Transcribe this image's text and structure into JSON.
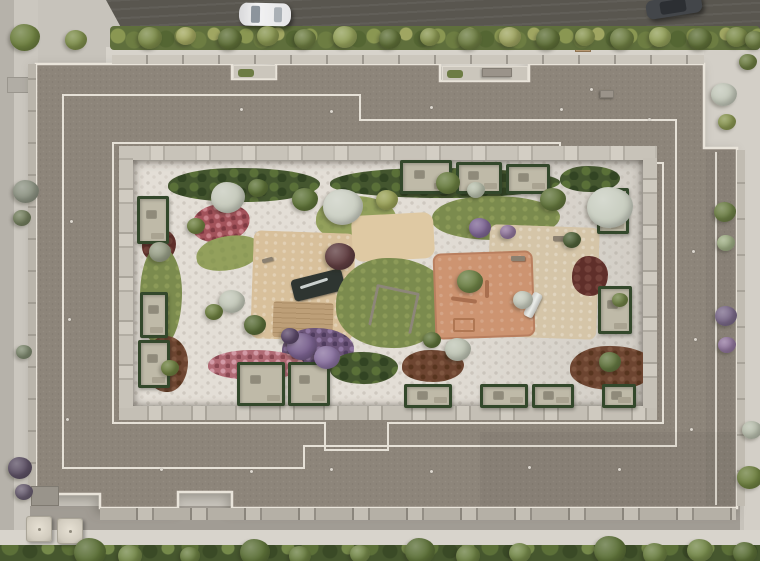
{
  "scene": {
    "type": "aerial-architectural-render",
    "description": "Top-down aerial 3D rendering of a residential perimeter-block building with stepped grey flat roofs, a landscaped inner courtyard with pebble paths, lawns, flower beds, playgrounds and private ground-floor terraces, surrounded by streets, sidewalks and greenery",
    "palette": {
      "road": "#59564f",
      "sidewalk": "#d7d3cb",
      "ground": "#c7c3bb",
      "roof": "#8d857a",
      "parapet": "#e9e4da",
      "courtyard_pebble": "#e3ded6",
      "lawn": "#7b8b4e",
      "hedge": "#44562f",
      "mulch": "#6d4531",
      "clay_playground": "#cd9471",
      "tan_playground": "#d8c09b",
      "water_feature": "#2e3531",
      "flowers_red": "#a2525a",
      "flowers_pink": "#b06a74",
      "flowers_purple": "#6b5478",
      "tree_green": "#5e7338",
      "tree_pale": "#c7ccbd",
      "car_white": "#f2f2f3",
      "car_dark": "#43464a"
    },
    "streets": {
      "vehicles": [
        {
          "name": "white-car",
          "color": "#f2f2f3",
          "location": "top road, center-left"
        },
        {
          "name": "dark-car",
          "color": "#43464a",
          "location": "top road, right, partially cropped"
        }
      ],
      "elements": [
        "top-road",
        "top-hedge-row-with-planters",
        "perimeter-sidewalks",
        "bottom-tree-row",
        "two-patio-umbrellas-bottom-left"
      ]
    },
    "building": {
      "form": "rectangular perimeter block with stepped parapets and rooftop terraces",
      "roof_vents": [
        {
          "x": 240,
          "y": 108
        },
        {
          "x": 330,
          "y": 110
        },
        {
          "x": 430,
          "y": 106
        },
        {
          "x": 560,
          "y": 108
        },
        {
          "x": 648,
          "y": 118
        },
        {
          "x": 70,
          "y": 220
        },
        {
          "x": 68,
          "y": 318
        },
        {
          "x": 66,
          "y": 418
        },
        {
          "x": 692,
          "y": 250
        },
        {
          "x": 694,
          "y": 338
        },
        {
          "x": 690,
          "y": 428
        },
        {
          "x": 330,
          "y": 468
        },
        {
          "x": 430,
          "y": 470
        },
        {
          "x": 528,
          "y": 466
        },
        {
          "x": 618,
          "y": 468
        },
        {
          "x": 160,
          "y": 468
        },
        {
          "x": 250,
          "y": 470
        },
        {
          "x": 590,
          "y": 88
        }
      ]
    },
    "courtyard": {
      "features": [
        "pebble-mosaic-paths",
        "lawns",
        "flower-beds",
        "mulch-beds",
        "central-tan-playground",
        "water-feature",
        "wood-deck",
        "sand-play-area",
        "orange-clay-playground",
        "swing-set",
        "slide",
        "benches",
        "private-terraces-with-hedges"
      ],
      "private_terraces": [
        {
          "x": 400,
          "y": 160,
          "w": 52,
          "h": 34
        },
        {
          "x": 456,
          "y": 162,
          "w": 46,
          "h": 32
        },
        {
          "x": 506,
          "y": 164,
          "w": 44,
          "h": 30
        },
        {
          "x": 137,
          "y": 196,
          "w": 32,
          "h": 48
        },
        {
          "x": 140,
          "y": 292,
          "w": 28,
          "h": 46
        },
        {
          "x": 138,
          "y": 340,
          "w": 32,
          "h": 48
        },
        {
          "x": 597,
          "y": 188,
          "w": 32,
          "h": 46
        },
        {
          "x": 598,
          "y": 286,
          "w": 34,
          "h": 48
        },
        {
          "x": 237,
          "y": 362,
          "w": 48,
          "h": 44
        },
        {
          "x": 288,
          "y": 362,
          "w": 42,
          "h": 44
        },
        {
          "x": 404,
          "y": 384,
          "w": 48,
          "h": 24
        },
        {
          "x": 480,
          "y": 384,
          "w": 48,
          "h": 24
        },
        {
          "x": 532,
          "y": 384,
          "w": 42,
          "h": 24
        },
        {
          "x": 602,
          "y": 384,
          "w": 34,
          "h": 24
        }
      ]
    },
    "vegetation": {
      "trees": [
        {
          "x": 25,
          "y": 38,
          "r": 15,
          "c": "#6e8040"
        },
        {
          "x": 76,
          "y": 40,
          "r": 11,
          "c": "#7f8f4c"
        },
        {
          "x": 150,
          "y": 38,
          "r": 12,
          "c": "#7d8c4a"
        },
        {
          "x": 186,
          "y": 36,
          "r": 10,
          "c": "#a5aa62"
        },
        {
          "x": 230,
          "y": 39,
          "r": 12,
          "c": "#5f7038"
        },
        {
          "x": 268,
          "y": 36,
          "r": 11,
          "c": "#8a9752"
        },
        {
          "x": 305,
          "y": 39,
          "r": 11,
          "c": "#6d7d42"
        },
        {
          "x": 345,
          "y": 37,
          "r": 12,
          "c": "#93a05a"
        },
        {
          "x": 390,
          "y": 39,
          "r": 11,
          "c": "#5f7038"
        },
        {
          "x": 430,
          "y": 37,
          "r": 10,
          "c": "#8a9752"
        },
        {
          "x": 470,
          "y": 39,
          "r": 12,
          "c": "#6d7d42"
        },
        {
          "x": 510,
          "y": 37,
          "r": 11,
          "c": "#a0a662"
        },
        {
          "x": 548,
          "y": 39,
          "r": 12,
          "c": "#5f7038"
        },
        {
          "x": 585,
          "y": 37,
          "r": 10,
          "c": "#8a9752"
        },
        {
          "x": 622,
          "y": 39,
          "r": 12,
          "c": "#6d7d42"
        },
        {
          "x": 660,
          "y": 37,
          "r": 11,
          "c": "#93a05a"
        },
        {
          "x": 700,
          "y": 39,
          "r": 12,
          "c": "#5f7038"
        },
        {
          "x": 737,
          "y": 37,
          "r": 11,
          "c": "#7d8c4a"
        },
        {
          "x": 755,
          "y": 40,
          "r": 10,
          "c": "#6d7d42"
        },
        {
          "x": 26,
          "y": 192,
          "r": 13,
          "c": "#8d9383"
        },
        {
          "x": 22,
          "y": 218,
          "r": 9,
          "c": "#75805f"
        },
        {
          "x": 24,
          "y": 352,
          "r": 8,
          "c": "#7f8a70"
        },
        {
          "x": 20,
          "y": 468,
          "r": 12,
          "c": "#5e5266"
        },
        {
          "x": 24,
          "y": 492,
          "r": 9,
          "c": "#6a5f72"
        },
        {
          "x": 724,
          "y": 95,
          "r": 13,
          "c": "#c3c8ba"
        },
        {
          "x": 727,
          "y": 122,
          "r": 9,
          "c": "#8a9752"
        },
        {
          "x": 725,
          "y": 212,
          "r": 11,
          "c": "#6d7f46"
        },
        {
          "x": 726,
          "y": 243,
          "r": 9,
          "c": "#9fae85"
        },
        {
          "x": 726,
          "y": 316,
          "r": 11,
          "c": "#7b6a8a"
        },
        {
          "x": 727,
          "y": 345,
          "r": 9,
          "c": "#93789f"
        },
        {
          "x": 748,
          "y": 62,
          "r": 9,
          "c": "#6d7d42"
        },
        {
          "x": 752,
          "y": 430,
          "r": 10,
          "c": "#b9bfae"
        },
        {
          "x": 750,
          "y": 478,
          "r": 13,
          "c": "#6e8040"
        },
        {
          "x": 228,
          "y": 197,
          "r": 17,
          "c": "#c6cabc"
        },
        {
          "x": 258,
          "y": 188,
          "r": 10,
          "c": "#5f7439"
        },
        {
          "x": 305,
          "y": 200,
          "r": 13,
          "c": "#5f7439"
        },
        {
          "x": 343,
          "y": 207,
          "r": 20,
          "c": "#ccd0c4"
        },
        {
          "x": 387,
          "y": 200,
          "r": 11,
          "c": "#9aa258"
        },
        {
          "x": 448,
          "y": 183,
          "r": 12,
          "c": "#687c3f"
        },
        {
          "x": 476,
          "y": 190,
          "r": 9,
          "c": "#b9c0ad"
        },
        {
          "x": 553,
          "y": 200,
          "r": 13,
          "c": "#62753c"
        },
        {
          "x": 610,
          "y": 208,
          "r": 23,
          "c": "#c9cec1"
        },
        {
          "x": 196,
          "y": 226,
          "r": 9,
          "c": "#6e8040"
        },
        {
          "x": 160,
          "y": 252,
          "r": 11,
          "c": "#99a088"
        },
        {
          "x": 232,
          "y": 302,
          "r": 13,
          "c": "#c2c7b8"
        },
        {
          "x": 255,
          "y": 325,
          "r": 11,
          "c": "#5a6d38"
        },
        {
          "x": 214,
          "y": 312,
          "r": 9,
          "c": "#6e8040"
        },
        {
          "x": 340,
          "y": 257,
          "r": 15,
          "c": "#5f3d40"
        },
        {
          "x": 302,
          "y": 347,
          "r": 15,
          "c": "#79618e"
        },
        {
          "x": 327,
          "y": 358,
          "r": 13,
          "c": "#8a72a0"
        },
        {
          "x": 290,
          "y": 336,
          "r": 9,
          "c": "#5d4a6b"
        },
        {
          "x": 470,
          "y": 282,
          "r": 13,
          "c": "#6c8045"
        },
        {
          "x": 523,
          "y": 300,
          "r": 10,
          "c": "#c6cbbd"
        },
        {
          "x": 458,
          "y": 350,
          "r": 13,
          "c": "#bfc5b5"
        },
        {
          "x": 432,
          "y": 340,
          "r": 9,
          "c": "#5e7239"
        },
        {
          "x": 610,
          "y": 362,
          "r": 11,
          "c": "#647741"
        },
        {
          "x": 480,
          "y": 228,
          "r": 11,
          "c": "#7f6795"
        },
        {
          "x": 508,
          "y": 232,
          "r": 8,
          "c": "#93789f"
        },
        {
          "x": 572,
          "y": 240,
          "r": 9,
          "c": "#50633a"
        },
        {
          "x": 620,
          "y": 300,
          "r": 8,
          "c": "#708245"
        },
        {
          "x": 170,
          "y": 368,
          "r": 9,
          "c": "#6e8040"
        },
        {
          "x": 90,
          "y": 552,
          "r": 16,
          "c": "#5c7038"
        },
        {
          "x": 130,
          "y": 556,
          "r": 12,
          "c": "#75894a"
        },
        {
          "x": 190,
          "y": 556,
          "r": 10,
          "c": "#6b7f42"
        },
        {
          "x": 255,
          "y": 553,
          "r": 15,
          "c": "#5c7038"
        },
        {
          "x": 300,
          "y": 556,
          "r": 11,
          "c": "#6b7f42"
        },
        {
          "x": 360,
          "y": 554,
          "r": 10,
          "c": "#75894a"
        },
        {
          "x": 420,
          "y": 552,
          "r": 15,
          "c": "#5c7038"
        },
        {
          "x": 468,
          "y": 556,
          "r": 12,
          "c": "#6b7f42"
        },
        {
          "x": 520,
          "y": 553,
          "r": 11,
          "c": "#75894a"
        },
        {
          "x": 610,
          "y": 550,
          "r": 16,
          "c": "#5c7038"
        },
        {
          "x": 655,
          "y": 554,
          "r": 12,
          "c": "#6b7f42"
        },
        {
          "x": 700,
          "y": 551,
          "r": 13,
          "c": "#75894a"
        },
        {
          "x": 745,
          "y": 553,
          "r": 12,
          "c": "#5c7038"
        }
      ]
    }
  }
}
